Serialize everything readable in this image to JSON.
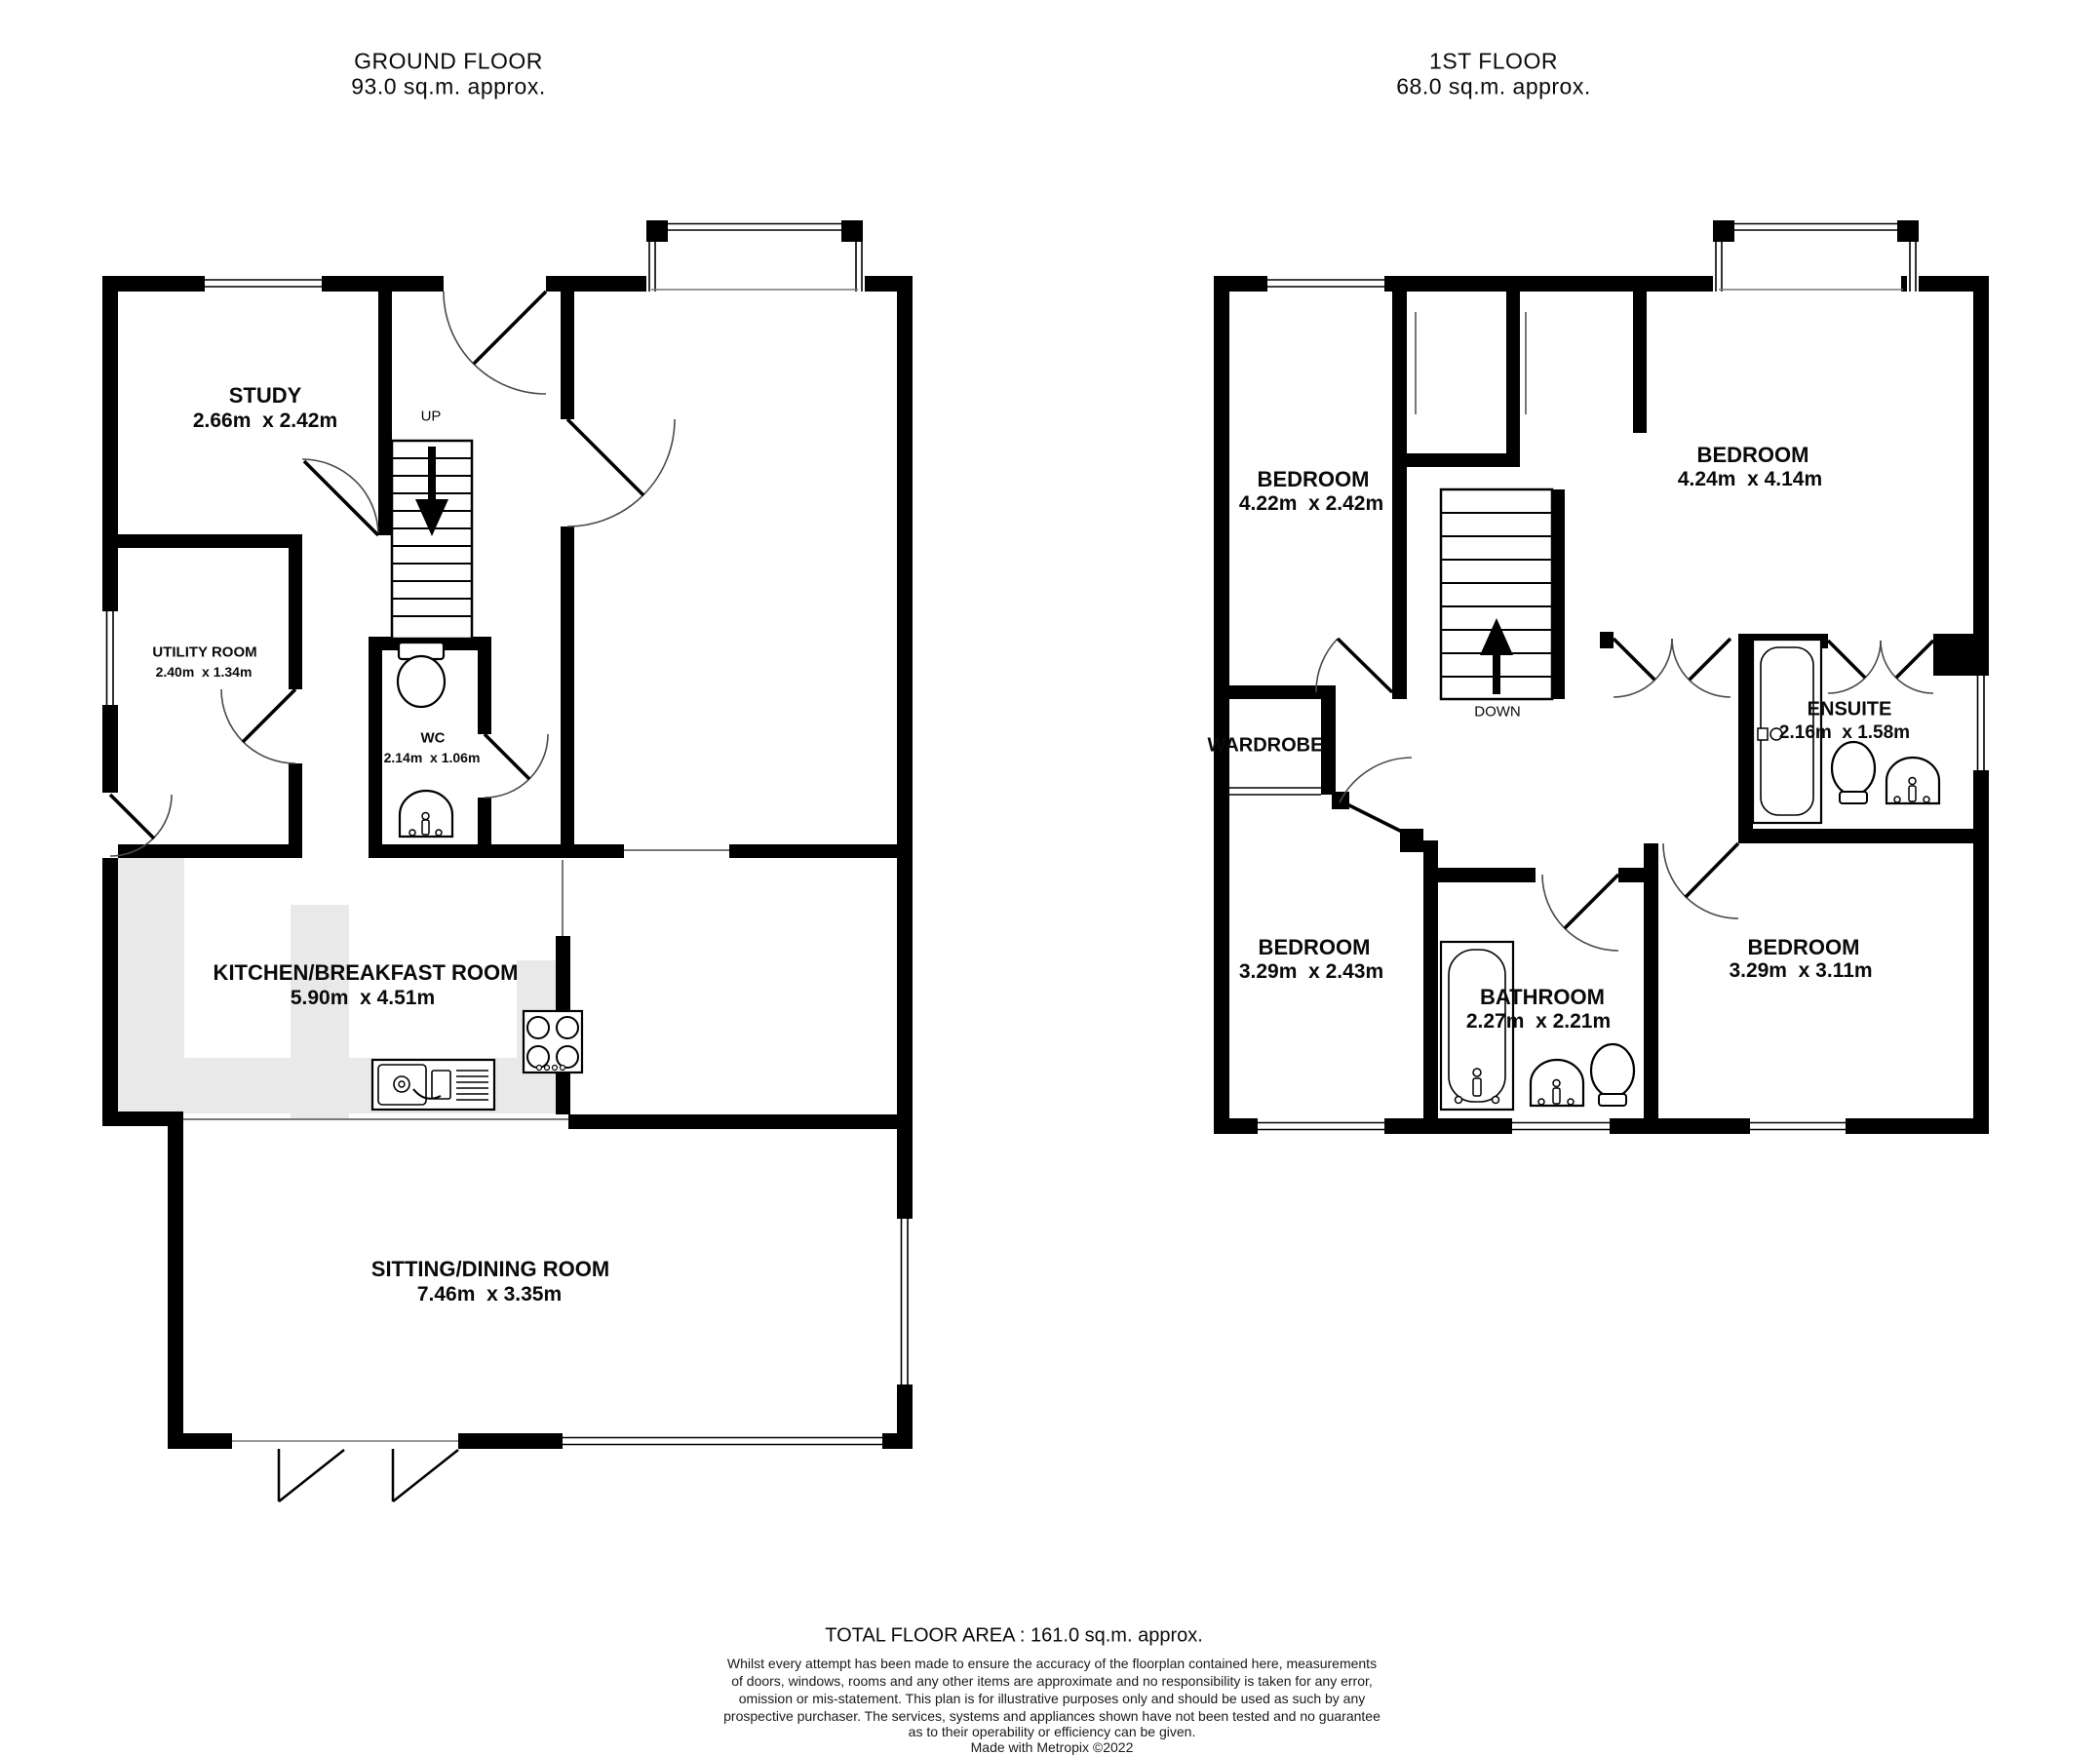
{
  "floors": {
    "ground": {
      "title": "GROUND FLOOR",
      "subtitle": "93.0 sq.m. approx."
    },
    "first": {
      "title": "1ST FLOOR",
      "subtitle": "68.0 sq.m. approx."
    }
  },
  "rooms": {
    "study": {
      "name": "STUDY",
      "dims": "2.66m  x 2.42m"
    },
    "utility": {
      "name": "UTILITY ROOM",
      "dims": "2.40m  x 1.34m"
    },
    "wc": {
      "name": "WC",
      "dims": "2.14m  x 1.06m"
    },
    "kitchen": {
      "name": "KITCHEN/BREAKFAST ROOM",
      "dims": "5.90m  x 4.51m"
    },
    "sitting": {
      "name": "SITTING/DINING ROOM",
      "dims": "7.46m  x 3.35m"
    },
    "bedroom_front": {
      "name": "BEDROOM",
      "dims": "4.22m  x 2.42m"
    },
    "bedroom_master": {
      "name": "BEDROOM",
      "dims": "4.24m  x 4.14m"
    },
    "bedroom_back_left": {
      "name": "BEDROOM",
      "dims": "3.29m  x 2.43m"
    },
    "bedroom_back_right": {
      "name": "BEDROOM",
      "dims": "3.29m  x 3.11m"
    },
    "bathroom": {
      "name": "BATHROOM",
      "dims": "2.27m  x 2.21m"
    },
    "ensuite": {
      "name": "ENSUITE",
      "dims": "2.16m  x 1.58m"
    },
    "wardrobe": {
      "name": "WARDROBE"
    }
  },
  "stairs": {
    "up_label": "UP",
    "down_label": "DOWN"
  },
  "footer": {
    "total_area": "TOTAL FLOOR AREA : 161.0 sq.m. approx.",
    "disclaimer_lines": [
      "Whilst every attempt has been made to ensure the accuracy of the floorplan contained here, measurements",
      "of doors, windows, rooms and any other items are approximate and no responsibility is taken for any error,",
      "omission or mis-statement. This plan is for illustrative purposes only and should be used as such by any",
      "prospective purchaser. The services, systems and appliances shown have not been tested and no guarantee",
      "as to their operability or efficiency can be given."
    ],
    "credit": "Made with Metropix ©2022"
  },
  "colors": {
    "wall": "#000000",
    "counter": "#e9e9e9",
    "arc": "#4a4a4a"
  }
}
